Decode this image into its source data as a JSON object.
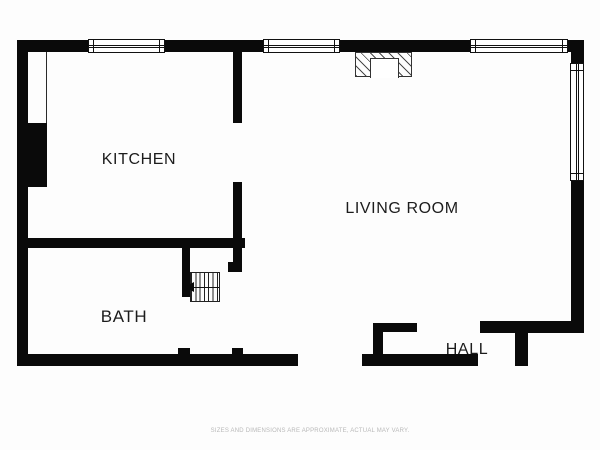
{
  "rooms": {
    "kitchen": {
      "label": "KITCHEN"
    },
    "living_room": {
      "label": "LIVING ROOM"
    },
    "bath": {
      "label": "BATH"
    },
    "hall": {
      "label": "HALL"
    }
  },
  "footer": {
    "disclaimer": "SIZES AND DIMENSIONS ARE APPROXIMATE, ACTUAL MAY VARY."
  },
  "symbols": {
    "stairs": "staircase-with-treads",
    "stairs_arrow": "left-arrow",
    "fireplace": "hatched-fireplace-with-firebox",
    "window_top_count": 3,
    "window_right_count": 1
  },
  "colors": {
    "wall": "#0a0a0a",
    "label_text": "#1c1c1c",
    "disclaimer_text": "#b9b9b9",
    "background": "#fdfdfd"
  }
}
